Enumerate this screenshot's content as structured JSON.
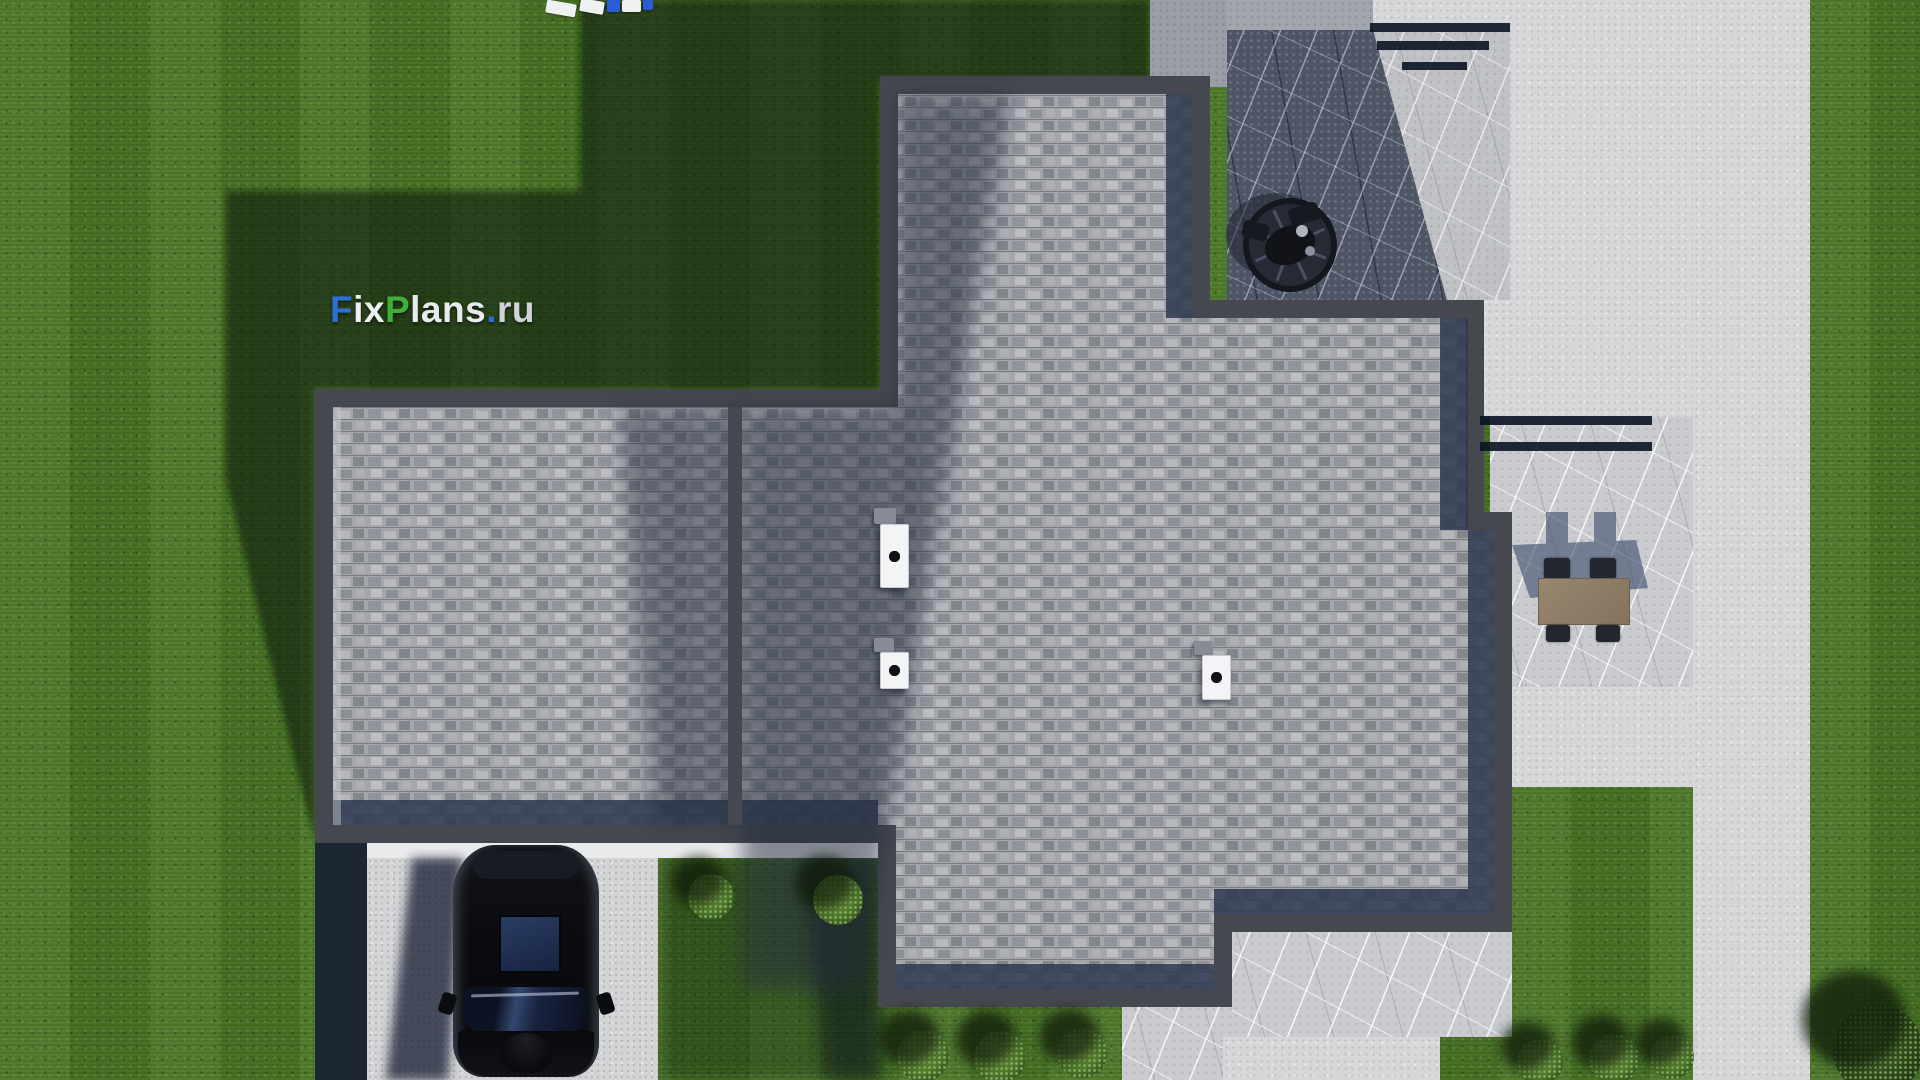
{
  "watermark": {
    "text": "FixPlans.ru",
    "segments": [
      {
        "t": "F",
        "c": "#2e6fd6"
      },
      {
        "t": "ix",
        "c": "#eef0f3"
      },
      {
        "t": "P",
        "c": "#3fae3f"
      },
      {
        "t": "lans",
        "c": "#e9eaee"
      },
      {
        "t": ".",
        "c": "#2e6fd6"
      },
      {
        "t": "ru",
        "c": "#d2d3d8"
      }
    ]
  },
  "scene": {
    "description": "Aerial top-down 3D architectural render of a flat-roof house with gray shingle roofing and dark parapet, lawn with cast shadows, stone patios, driveway with a black car, round grill on a shaded patio, outdoor dining table with four chairs, trimmed bushes and a concrete walkway",
    "lawn": {
      "sunlit_color": "#4f7a2b",
      "shadow_color": "#1f3315",
      "mow_stripes": true
    },
    "roof": {
      "shingle_color": "#a4a6ab",
      "shingle_dark_color": "#83858d",
      "parapet_color": "#45484f",
      "edge_shadow_color": "#2e3850"
    },
    "hardscape": {
      "concrete_color": "#d6d7d9",
      "shaded_concrete_color": "#9b9da7",
      "marble_light_color": "#c9cbce",
      "marble_dark_color": "#4e5565",
      "driveway_color": "#d3d4d6",
      "fascia_color": "#e9eaec"
    },
    "objects": {
      "car": {
        "label": "black car parked on driveway facing down",
        "body_color": "#0b0c0f",
        "sunroof_color": "#223558",
        "windshield_color": "#33476f"
      },
      "grill": {
        "label": "round grill on shaded stone patio",
        "color": "#252a34"
      },
      "dining_set": {
        "label": "outdoor table with four chairs",
        "table_color": "#8f7f6d",
        "chair_color": "#23262e",
        "chairs": 4
      },
      "roof_vents": [
        {
          "dots": 4
        },
        {
          "dots": 2
        },
        {
          "dots": 2
        }
      ],
      "bushes": {
        "count": 9,
        "color": "#55842f"
      },
      "playground": {
        "label": "white and blue slats at top edge of frame",
        "colors": [
          "#eef0f2",
          "#2b5cd8"
        ]
      },
      "railing_shadow_bars": {
        "top_set": 3,
        "right_set": 2,
        "color": "#0c1424"
      }
    }
  }
}
